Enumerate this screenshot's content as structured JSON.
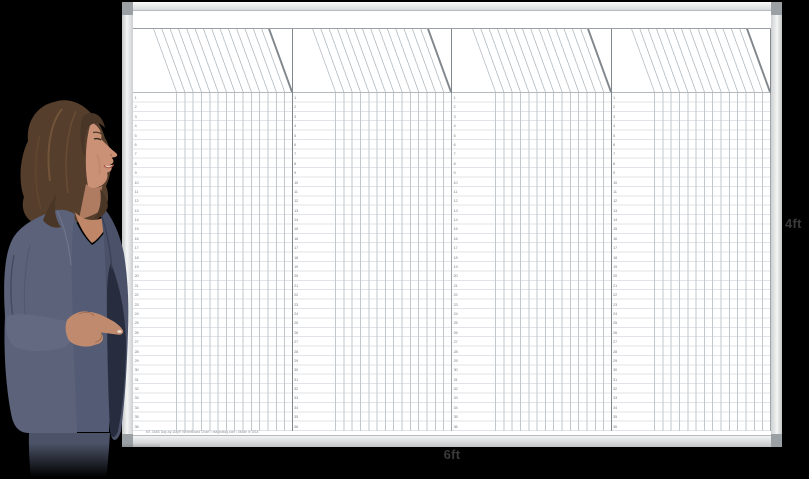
{
  "scene": {
    "background_color": "#000000",
    "alt": "Businesswoman in a slate-blue suit standing at left, pointing at a large blank day-by-day scheduling whiteboard"
  },
  "dimension_labels": {
    "width": "6ft",
    "height": "4ft",
    "color": "#3a3a3a"
  },
  "board": {
    "surface_color": "#ffffff",
    "frame": {
      "corner_cap_color": "#9ba0a4"
    },
    "grid": {
      "panel_count": 4,
      "rows_per_panel": 36,
      "columns_per_panel": 14,
      "row_line_color": "#e0e3e7",
      "column_line_color": "#c2c7cc",
      "divider_color": "#80878d",
      "header_rule_color": "#9aa0a5",
      "diagonal_line_color": "#bfc4c9",
      "row_numbers": [
        1,
        2,
        3,
        4,
        5,
        6,
        7,
        8,
        9,
        10,
        11,
        12,
        13,
        14,
        15,
        16,
        17,
        18,
        19,
        20,
        21,
        22,
        23,
        24,
        25,
        26,
        27,
        28,
        29,
        30,
        31,
        32,
        33,
        34,
        35,
        36
      ]
    },
    "fine_print": "MT-344B Day-by-Day® WhiteBoard Chart • magnatag.com • Made in USA"
  },
  "person": {
    "description": "woman presenter, brown shoulder-length hair, slate-blue blazer and skirt, smiling in profile, pointing at board",
    "hair_color": "#553e2c",
    "hair_dark_color": "#4a3627",
    "skin_color": "#cb9176",
    "skin_shadow_color": "#b07c61",
    "chest_color": "#c08668",
    "jacket_color": "#5b6279",
    "jacket_dark_color": "#4a5168",
    "jacket_flap_color": "#272d3e",
    "sleeve_color": "#626980",
    "dress_color": "#535c74",
    "skirt_color": "#4c5368",
    "hand_color": "#c08a6e",
    "lip_color": "#a65243"
  }
}
